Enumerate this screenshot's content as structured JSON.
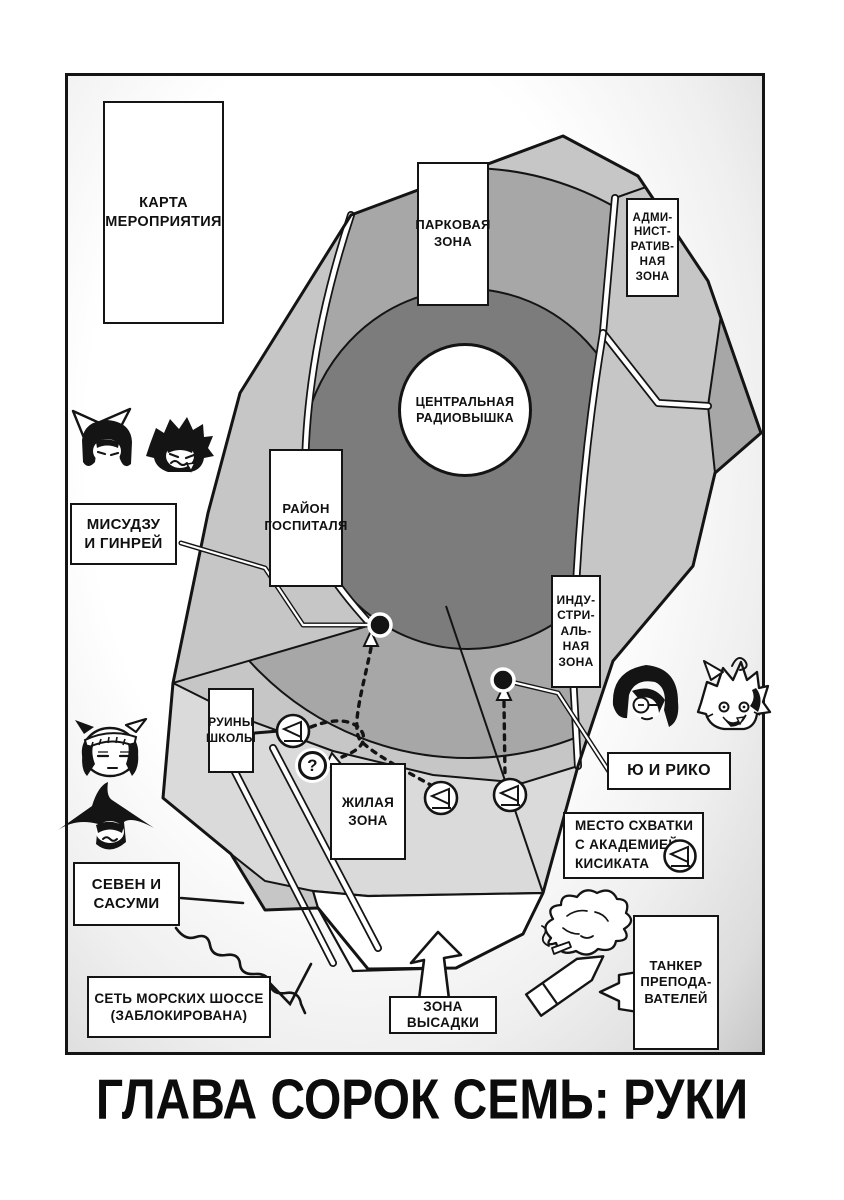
{
  "page": {
    "chapter_title": "ГЛАВА СОРОК СЕМЬ: РУКИ"
  },
  "colors": {
    "ink": "#141414",
    "paper": "#ffffff",
    "zone_light": "#c6c6c6",
    "zone_mid": "#a7a7a7",
    "zone_dark": "#7c7c7c",
    "zone_residential": "#dadada"
  },
  "map": {
    "legend_box": "КАРТА\nМЕРОПРИЯТИЯ",
    "zones": {
      "park": "ПАРКОВАЯ\nЗОНА",
      "admin": "АДМИ-\nНИСТ-\nРАТИВ-\nНАЯ\nЗОНА",
      "radio_tower": "ЦЕНТРАЛЬНАЯ\nРАДИОВЫШКА",
      "hospital": "РАЙОН\nГОСПИТАЛЯ",
      "industrial": "ИНДУ-\nСТРИ-\nАЛЬ-\nНАЯ\nЗОНА",
      "school_ruins": "РУИНЫ\nШКОЛЫ",
      "residential": "ЖИЛАЯ\nЗОНА",
      "landing": "ЗОНА\nВЫСАДКИ"
    },
    "callouts": {
      "misuzu_ginrei": "МИСУДЗУ\nИ ГИНРЕЙ",
      "yu_riko": "Ю И РИКО",
      "seven_sasumi": "СЕВЕН И\nСАСУМИ",
      "fight_site": "МЕСТО СХВАТКИ\nС АКАДЕМИЕЙ\nКИСИКАТА",
      "teachers_tanker": "ТАНКЕР\nПРЕПОДА-\nВАТЕЛЕЙ",
      "sea_highways": "СЕТЬ МОРСКИХ ШОССЕ\n(ЗАБЛОКИРОВАНА)"
    },
    "markers": {
      "question": "?",
      "icons": {
        "flag_marker": "flag-in-circle",
        "location_dot": "black-dot",
        "route_arrow": "dashed-route-arrow",
        "landing_arrow": "big-up-arrow",
        "tanker_ship": "tanker-silhouette",
        "blocked_route": "wavy-line"
      }
    }
  }
}
